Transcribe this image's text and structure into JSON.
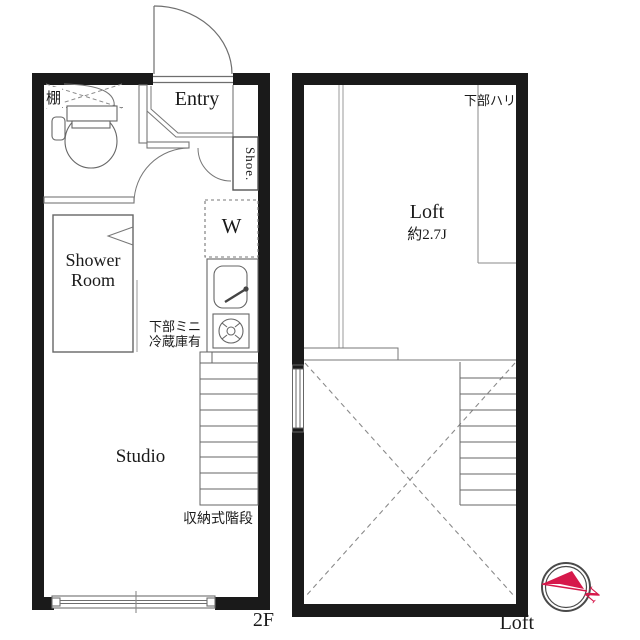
{
  "plans": {
    "second_floor": {
      "floor_label": "2F",
      "entry_label": "Entry",
      "shoe_label": "Shoe.",
      "washer_label": "W",
      "shower_label": "Shower Room",
      "studio_label": "Studio",
      "shelf_label": "棚",
      "fridge_note_line1": "下部ミニ",
      "fridge_note_line2": "冷蔵庫有",
      "stairs_label": "収納式階段"
    },
    "loft": {
      "floor_label": "Loft",
      "room_label": "Loft",
      "room_size": "約2.7J",
      "beam_label": "下部ハリ"
    }
  },
  "compass": {
    "north_label": "N",
    "accent_color": "#d6194b",
    "ring_color": "#4a4a4a"
  },
  "colors": {
    "wall": "#1a1a1a",
    "fixture_line": "#6e6e6e",
    "light_line": "#8a8a8a",
    "background": "#ffffff"
  }
}
